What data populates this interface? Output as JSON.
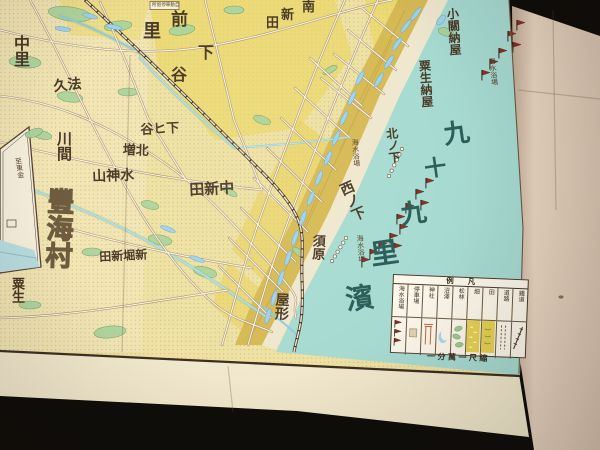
{
  "photo": {
    "backdrop": "#0f0d0a",
    "blank_margin_paper": "#ead6c2",
    "sheet_paper": "#f1e8cd"
  },
  "map": {
    "colors": {
      "land": "#eee1a3",
      "sea": "#a7dbd2",
      "dune": "#d6ba55",
      "sand": "#efe8cf",
      "field_yellow": "#ebd55c",
      "ink": "#4a3927",
      "sea_text": "#2b5e59",
      "flag": "#8a2f22",
      "neatline": "#3c2f22"
    },
    "labels_vertical": [
      {
        "name": "nakazato",
        "text": "中里",
        "x": 11,
        "y": 35,
        "s": 16,
        "rot": 0
      },
      {
        "name": "kawama",
        "text": "川間",
        "x": 55,
        "y": 131,
        "s": 15,
        "rot": 0
      },
      {
        "name": "toyoumi-mura",
        "text": "豐海村",
        "x": 45,
        "y": 187,
        "s": 27,
        "rot": 2,
        "cls": "outline"
      },
      {
        "name": "aoi",
        "text": "粟生",
        "x": 11,
        "y": 277,
        "s": 13,
        "rot": 0
      },
      {
        "name": "yakata",
        "text": "屋形",
        "x": 274,
        "y": 292,
        "s": 14,
        "rot": 3
      },
      {
        "name": "suhara",
        "text": "須原",
        "x": 312,
        "y": 234,
        "s": 13,
        "rot": 2
      },
      {
        "name": "nishi-no-shita",
        "text": "西ノ下",
        "x": 336,
        "y": 185,
        "s": 14,
        "rot": -24
      },
      {
        "name": "kita-no-shita",
        "text": "北ノ下",
        "x": 385,
        "y": 128,
        "s": 12,
        "rot": -6
      },
      {
        "name": "aoi-naya",
        "text": "粟生納屋",
        "x": 418,
        "y": 60,
        "s": 12,
        "rot": -4
      },
      {
        "name": "kozeki-naya",
        "text": "小關納屋",
        "x": 446,
        "y": 8,
        "s": 12,
        "rot": -4
      },
      {
        "name": "kaisuiyokujo-north",
        "text": "海水浴場",
        "x": 488,
        "y": 58,
        "s": 7,
        "rot": -6,
        "cls": "tiny"
      },
      {
        "name": "kaisuiyokujo-mid",
        "text": "海水浴場",
        "x": 351,
        "y": 139,
        "s": 7,
        "rot": -4,
        "cls": "tiny"
      },
      {
        "name": "kaisuiyokujo-south",
        "text": "海水浴場",
        "x": 356,
        "y": 235,
        "s": 7,
        "rot": -4,
        "cls": "tiny"
      },
      {
        "name": "inset-route-note",
        "text": "至東金",
        "x": 14,
        "y": 158,
        "s": 7,
        "rot": -9,
        "cls": "tiny"
      }
    ],
    "labels_rtl": [
      {
        "name": "hokyu",
        "text": "法久",
        "x": 53,
        "y": 81,
        "s": 14,
        "rot": -6
      },
      {
        "name": "shimohiya",
        "text": "下ヒ谷",
        "x": 140,
        "y": 123,
        "s": 13,
        "rot": -3
      },
      {
        "name": "kitamashi",
        "text": "北増",
        "x": 123,
        "y": 143,
        "s": 13,
        "rot": 2
      },
      {
        "name": "suijinyama",
        "text": "水神山",
        "x": 92,
        "y": 171,
        "s": 14,
        "rot": -2
      },
      {
        "name": "naka-shinden",
        "text": "中新田",
        "x": 189,
        "y": 184,
        "s": 15,
        "rot": -3
      },
      {
        "name": "shinbori-shinden",
        "text": "新堀新田",
        "x": 99,
        "y": 251,
        "s": 12,
        "rot": -3
      },
      {
        "name": "bus-stop-box-label",
        "text": "自動車停留所",
        "x": 152,
        "y": 3,
        "s": 4.6,
        "rot": 0,
        "cls": "tiny"
      }
    ],
    "labels_chars": [
      {
        "name": "mae-zato",
        "reading": "前里",
        "chars": "前里",
        "pos": [
          [
            171,
            11
          ],
          [
            143,
            22
          ]
        ],
        "sizes": [
          17,
          18
        ]
      },
      {
        "name": "shimo-ya",
        "reading": "下谷",
        "chars": "下谷",
        "pos": [
          [
            198,
            46
          ],
          [
            171,
            68
          ]
        ],
        "sizes": [
          16,
          16
        ]
      },
      {
        "name": "minami-shinden",
        "reading": "南新田",
        "chars": "南新田",
        "pos": [
          [
            302,
            0
          ],
          [
            281,
            8
          ],
          [
            266,
            16
          ]
        ],
        "sizes": [
          13,
          13,
          13
        ]
      },
      {
        "name": "kujukuri-hama",
        "reading": "九十九里濱",
        "chars": "九十九里濱",
        "pos": [
          [
            442,
            123
          ],
          [
            423,
            159
          ],
          [
            399,
            203
          ],
          [
            369,
            243
          ],
          [
            344,
            288
          ]
        ],
        "sizes": [
          26,
          22,
          26,
          28,
          28
        ],
        "cls": "seaink",
        "rot": -8
      }
    ],
    "flags": [
      [
        517,
        20
      ],
      [
        508,
        31
      ],
      [
        513,
        42
      ],
      [
        499,
        48
      ],
      [
        490,
        59
      ],
      [
        482,
        70
      ],
      [
        426,
        178
      ],
      [
        416,
        189
      ],
      [
        421,
        200
      ],
      [
        406,
        203
      ],
      [
        397,
        214
      ],
      [
        400,
        224
      ],
      [
        390,
        233
      ],
      [
        394,
        243
      ],
      [
        379,
        241
      ],
      [
        370,
        249
      ],
      [
        362,
        257
      ]
    ],
    "hut_rows": [
      {
        "x1": 402,
        "y1": 149,
        "x2": 389,
        "y2": 176,
        "n": 6
      },
      {
        "x1": 346,
        "y1": 238,
        "x2": 332,
        "y2": 261,
        "n": 6
      }
    ],
    "legend": {
      "title": "凡例",
      "scale_note": "縮尺一萬分一",
      "columns": [
        {
          "label": "海水浴場",
          "symbol": "flags"
        },
        {
          "label": "停車場",
          "symbol": "station"
        },
        {
          "label": "神社",
          "symbol": "torii"
        },
        {
          "label": "沼澤",
          "symbol": "marsh"
        },
        {
          "label": "松林",
          "symbol": "pine"
        },
        {
          "label": "畑",
          "symbol": "hatake"
        },
        {
          "label": "田",
          "symbol": "ta"
        },
        {
          "label": "道路",
          "symbol": "road"
        },
        {
          "label": "鐵道",
          "symbol": "rail"
        }
      ]
    }
  }
}
